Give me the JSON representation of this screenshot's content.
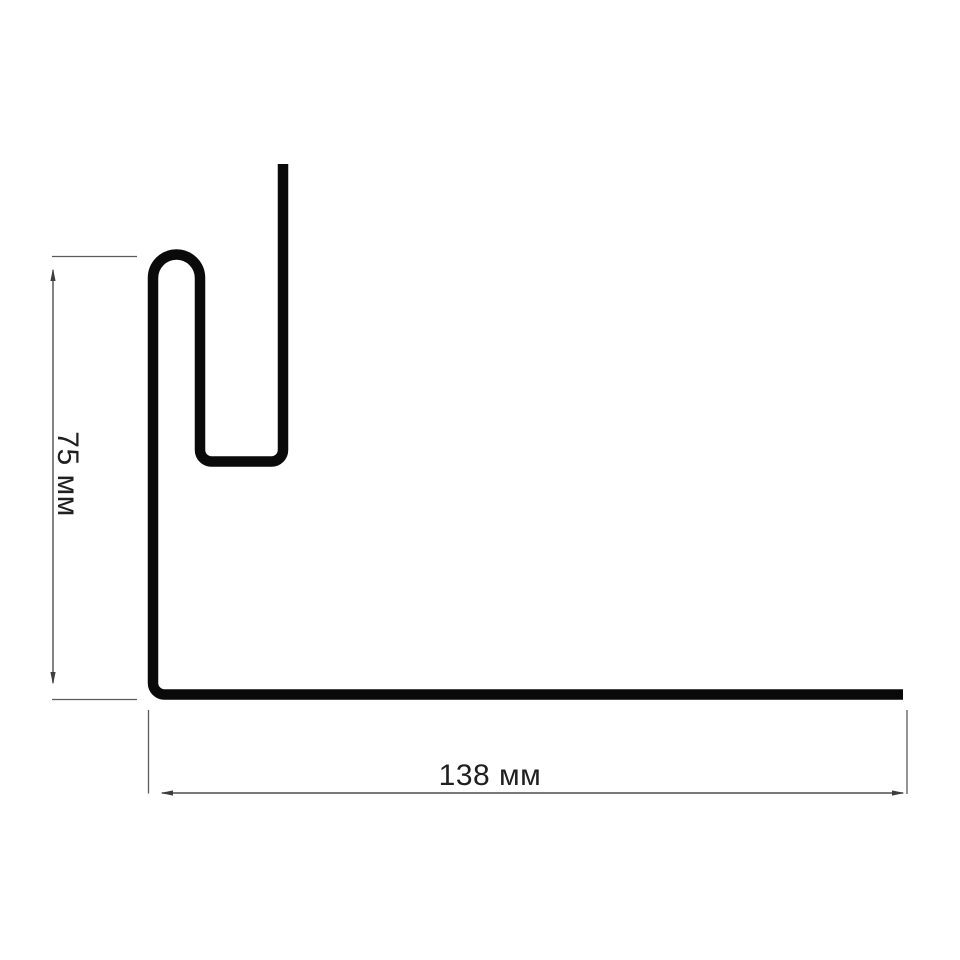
{
  "diagram": {
    "type": "siding-profile-cross-section",
    "labels": {
      "height": "75 мм",
      "width": "138 мм"
    },
    "dimensions": {
      "height_value": 75,
      "width_value": 138,
      "unit": "мм"
    },
    "colors": {
      "background": "#ffffff",
      "profile_line": "#0a0a0a",
      "dimension_line": "#4d4d4d",
      "label_text": "#1f1f1f"
    }
  }
}
